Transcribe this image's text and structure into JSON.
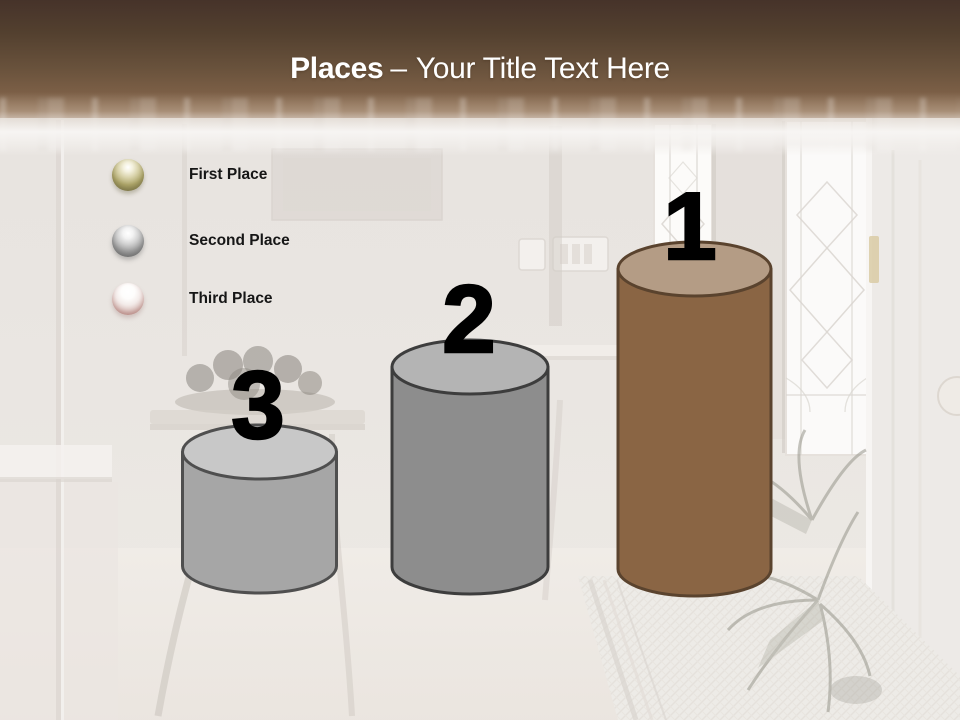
{
  "header": {
    "title_emphasis": "Places",
    "title_separator": "–",
    "title_text": "Your Title Text Here",
    "title_color": "#ffffff",
    "band_color_top": "#46332a",
    "band_color_bottom": "#97765a"
  },
  "legend": {
    "items": [
      {
        "label": "First Place",
        "icon": "gold-sphere-icon",
        "color": "#aca468"
      },
      {
        "label": "Second Place",
        "icon": "silver-sphere-icon",
        "color": "#a0a0a0"
      },
      {
        "label": "Third Place",
        "icon": "bronze-sphere-icon",
        "color": "#c9a6a1"
      }
    ]
  },
  "podium": {
    "type": "podium-cylinder-diagram",
    "items": [
      {
        "rank": "3",
        "position": "left",
        "body_color": "#a6a6a6",
        "top_color": "#c8c8c8",
        "outline_color": "#4f4f4f",
        "number_color": "#000000"
      },
      {
        "rank": "2",
        "position": "middle",
        "body_color": "#8d8d8d",
        "top_color": "#b4b4b4",
        "outline_color": "#3d3d3d",
        "number_color": "#000000"
      },
      {
        "rank": "1",
        "position": "right",
        "body_color": "#8a6544",
        "top_color": "#b49c85",
        "outline_color": "#5a432e",
        "number_color": "#000000"
      }
    ]
  },
  "background": {
    "description": "Washed-out photo of a home entry hallway: open white door with brass hinges on the right, leaded-glass sidelight windows, palm plant over a patterned runner rug, and a side table with a bowl of fruit on the left"
  }
}
